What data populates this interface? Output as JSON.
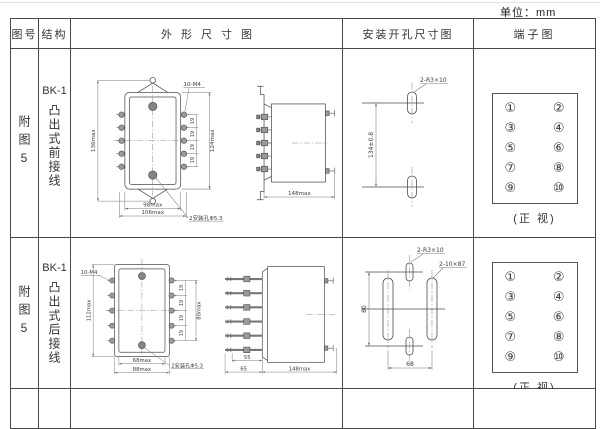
{
  "unit_label": "单位：mm",
  "headers": [
    "图号",
    "结构",
    "外形尺寸图",
    "安装开孔尺寸图",
    "端子图"
  ],
  "rows": [
    {
      "figure": "附图5",
      "model": "BK-1",
      "structure": "凸出式前接线",
      "outline": {
        "front": {
          "screws": "10-M4",
          "height_total": "136max",
          "pitch": [
            "19",
            "19",
            "19",
            "19"
          ],
          "height_side": "124max",
          "width_inner": "98max",
          "width_outer": "106max",
          "holes": "2安装孔Φ5.3"
        },
        "side": {
          "depth": "148max"
        }
      },
      "mounting": {
        "slot": "2-R3×10",
        "span": "134±0.8"
      },
      "terminal": {
        "left": [
          "①",
          "③",
          "⑤",
          "⑦",
          "⑨"
        ],
        "right": [
          "②",
          "④",
          "⑥",
          "⑧",
          "⑩"
        ],
        "caption": "(正 视)"
      }
    },
    {
      "figure": "附图5",
      "model": "BK-1",
      "structure": "凸出式后接线",
      "outline": {
        "front": {
          "screws": "10-M4",
          "height_total": "112max",
          "pitch": [
            "19",
            "19",
            "19",
            "19"
          ],
          "height_side": "80max",
          "width_inner": "68max",
          "width_outer": "88max",
          "holes": "2安装孔Φ5.3"
        },
        "side": {
          "pin_inner": "55",
          "pin_outer": "65",
          "depth": "148max"
        }
      },
      "mounting": {
        "slot_small": "2-R3×10",
        "slot_long": "2-10×87",
        "span": "80",
        "width": "68"
      },
      "terminal": {
        "left": [
          "①",
          "③",
          "⑤",
          "⑦",
          "⑨"
        ],
        "right": [
          "②",
          "④",
          "⑥",
          "⑧",
          "⑩"
        ],
        "caption": "(正 视)"
      }
    }
  ]
}
